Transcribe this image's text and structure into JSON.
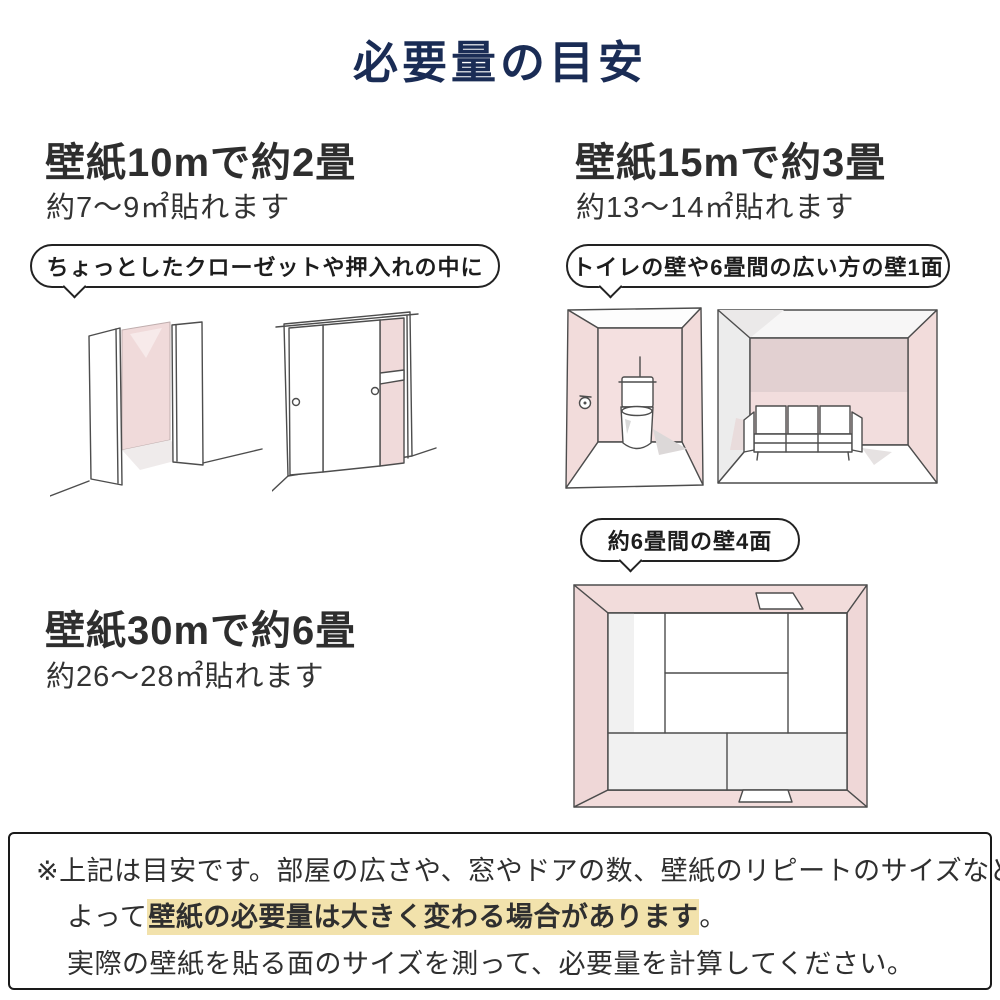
{
  "title": "必要量の目安",
  "sections": {
    "s10": {
      "heading": "壁紙10mで約2畳",
      "sub": "約7〜9㎡貼れます",
      "bubble": "ちょっとしたクローゼットや押入れの中に"
    },
    "s15": {
      "heading": "壁紙15mで約3畳",
      "sub": "約13〜14㎡貼れます",
      "bubble": "トイレの壁や6畳間の広い方の壁1面"
    },
    "s30": {
      "heading": "壁紙30mで約6畳",
      "sub": "約26〜28㎡貼れます",
      "bubble": "約6畳間の壁4面"
    }
  },
  "illustrations": {
    "left": [
      "open-closet-sketch",
      "sliding-closet-sketch"
    ],
    "right": [
      "toilet-room-sketch",
      "sofa-room-sketch"
    ],
    "bottom": [
      "tatami-room-sketch"
    ]
  },
  "note": {
    "line1": "※上記は目安です。部屋の広さや、窓やドアの数、壁紙のリピートのサイズなどに",
    "line2_prefix": "よって",
    "line2_highlight": "壁紙の必要量は大きく変わる場合があります",
    "line2_suffix": "。",
    "line3": "実際の壁紙を貼る面のサイズを測って、必要量を計算してください。"
  },
  "colors": {
    "title_navy": "#1a2c55",
    "text_dark": "#2f2f2f",
    "wall_pink": "#f2dcdb",
    "wall_pink_dark": "#e2d0d1",
    "highlight_yellow": "#f2e2ac",
    "outline_black": "#222222"
  }
}
